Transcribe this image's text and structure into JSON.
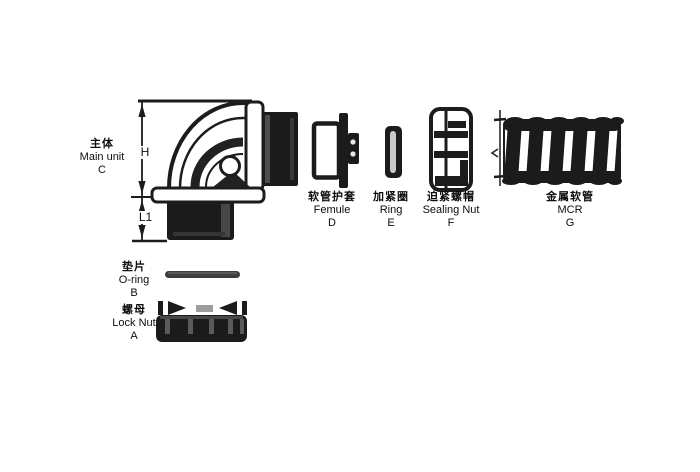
{
  "diagram": {
    "parts": {
      "main_unit": {
        "zh": "主体",
        "en": "Main unit",
        "code": "C"
      },
      "ferrule": {
        "zh": "软管护套",
        "en": "Femule",
        "code": "D"
      },
      "ring": {
        "zh": "加紧圈",
        "en": "Ring",
        "code": "E"
      },
      "sealing_nut": {
        "zh": "迫紧螺帽",
        "en": "Sealing Nut",
        "code": "F"
      },
      "conduit": {
        "zh": "金属软管",
        "en": "MCR",
        "code": "G"
      },
      "o_ring": {
        "zh": "垫片",
        "en": "O-ring",
        "code": "B"
      },
      "lock_nut": {
        "zh": "螺母",
        "en": "Lock Nut",
        "code": "A"
      }
    },
    "dimensions": {
      "height": "H",
      "length": "L1"
    },
    "colors": {
      "ink": "#1c1c1c",
      "background": "#ffffff"
    }
  }
}
